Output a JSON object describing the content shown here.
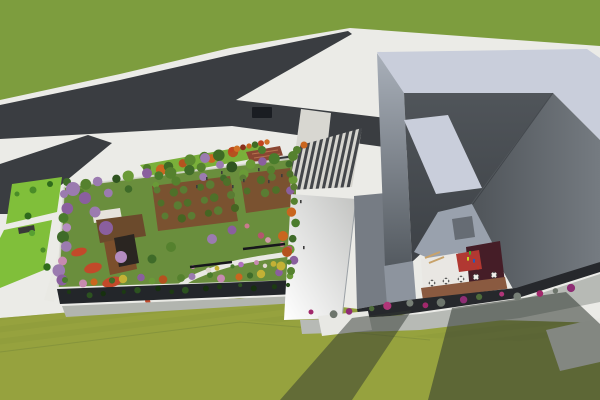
{
  "meta": {
    "title": "Aerial 3D architectural rendering",
    "description": "Bird's-eye render: angular gray museum building with courtyard cafe terrace, rooftop garden with orchards and winding paths, striped entry plaza, Y-shaped asphalt roads, lawns and flowering trees."
  },
  "colors": {
    "sidewalk": "#ebebe7",
    "sidewalk_shaded": "#b7bab5",
    "grass_north": "#7d9d3e",
    "lawn_south": "#96a23e",
    "lawn_bright": "#80bf3a",
    "road": "#3a3d41",
    "crosswalk": "#d8d7d1",
    "garden_lawn": "#6a8e3d",
    "soil": "#7a5230",
    "deck_wood": "#6b4a2c",
    "deck_dark": "#2a2521",
    "pergola_white": "#e6e3dc",
    "red_flowers": "#c2492a",
    "path": "#e9e9e4",
    "facade_dark": "#23262a",
    "facade_shadow": "#b2b5af",
    "amphitheater": "#8a4632",
    "pavilion": "#33363a",
    "parapet": "#c9cedb",
    "courtyard_wall": "#99a1ad",
    "floor_white": "#e9e7e3",
    "floor_red": "#b13832",
    "floor_maroon": "#451d27",
    "terrace": "#8a5a40",
    "panel_gray": "#666c74",
    "base_dark": "#26282c",
    "shadow": "#2f3630",
    "white_patch": "#e8e8e4"
  },
  "scene": {
    "tree_rows": [
      {
        "x1": 150,
        "y1": 170,
        "x2": 232,
        "y2": 152,
        "n": 9,
        "rmin": 4,
        "rmax": 6,
        "j": 1,
        "colors": [
          "#4f7d2b",
          "#c9661f",
          "#3f6b24",
          "#b5521f",
          "#5c8a30"
        ]
      },
      {
        "x1": 231,
        "y1": 150,
        "x2": 267,
        "y2": 142,
        "n": 7,
        "rmin": 2.5,
        "rmax": 3.5,
        "j": 0,
        "colors": [
          "#c0441f",
          "#d07026",
          "#8a2f1a",
          "#c9661f",
          "#3f6b24"
        ]
      },
      {
        "x1": 70,
        "y1": 184,
        "x2": 292,
        "y2": 158,
        "n": 16,
        "rmin": 4,
        "rmax": 6,
        "j": 1,
        "colors": [
          "#3f6b29",
          "#55812e",
          "#9b7bb0",
          "#2f5420",
          "#6a9a37",
          "#8a5f9e",
          "#4a7c2c",
          "#55812e"
        ]
      },
      {
        "x1": 84,
        "y1": 194,
        "x2": 270,
        "y2": 170,
        "n": 9,
        "rmin": 3,
        "rmax": 5,
        "j": 1,
        "colors": [
          "#55812e",
          "#9b7bb0",
          "#3f6b29",
          "#6a9a37"
        ]
      },
      {
        "x1": 67,
        "y1": 196,
        "x2": 61,
        "y2": 280,
        "n": 9,
        "rmin": 4,
        "rmax": 6.5,
        "j": 1,
        "colors": [
          "#9b7bb0",
          "#8a5f9e",
          "#4a7c2c",
          "#b48cc0",
          "#3f6b29",
          "#9b7bb0",
          "#c78ab0"
        ]
      },
      {
        "x1": 68,
        "y1": 282,
        "x2": 292,
        "y2": 274,
        "n": 17,
        "rmin": 3,
        "rmax": 4.5,
        "j": 1,
        "colors": [
          "#4a7c2c",
          "#c78ab0",
          "#c9661f",
          "#3f6b29",
          "#c3b135",
          "#8a5f9e",
          "#6a9a37",
          "#b5521f",
          "#55812e",
          "#9b7bb0"
        ]
      },
      {
        "x1": 292,
        "y1": 166,
        "x2": 293,
        "y2": 272,
        "n": 10,
        "rmin": 3.5,
        "rmax": 5,
        "j": 1,
        "colors": [
          "#3f6b29",
          "#6a9a37",
          "#8a5f9e",
          "#55812e",
          "#c9661f",
          "#4a7c2c"
        ]
      },
      {
        "x1": 160,
        "y1": 192,
        "x2": 224,
        "y2": 184,
        "n": 6,
        "rmin": 3.5,
        "rmax": 4.5,
        "j": 1,
        "colors": [
          "#5a7c33",
          "#4e7029"
        ]
      },
      {
        "x1": 164,
        "y1": 205,
        "x2": 228,
        "y2": 197,
        "n": 6,
        "rmin": 3.5,
        "rmax": 4.5,
        "j": 1,
        "colors": [
          "#4e7029",
          "#5a7c33"
        ]
      },
      {
        "x1": 168,
        "y1": 218,
        "x2": 232,
        "y2": 210,
        "n": 6,
        "rmin": 3.5,
        "rmax": 4.5,
        "j": 1,
        "colors": [
          "#5a7c33",
          "#466522"
        ]
      },
      {
        "x1": 246,
        "y1": 180,
        "x2": 288,
        "y2": 174,
        "n": 4,
        "rmin": 3.5,
        "rmax": 4.5,
        "j": 1,
        "colors": [
          "#5a7c33",
          "#4e7029"
        ]
      },
      {
        "x1": 250,
        "y1": 193,
        "x2": 292,
        "y2": 187,
        "n": 4,
        "rmin": 3.5,
        "rmax": 4.5,
        "j": 1,
        "colors": [
          "#4e7029",
          "#5a7c33"
        ]
      },
      {
        "x1": 196,
        "y1": 269,
        "x2": 288,
        "y2": 262,
        "n": 9,
        "rmin": 2,
        "rmax": 3,
        "j": 1,
        "colors": [
          "#c78ab0",
          "#e0d8d0",
          "#c3b135",
          "#4a7c2c",
          "#b06fc0"
        ]
      },
      {
        "x1": 250,
        "y1": 228,
        "x2": 290,
        "y2": 250,
        "n": 5,
        "rmin": 2.5,
        "rmax": 3.5,
        "j": 1,
        "colors": [
          "#c97a8e",
          "#b4556f",
          "#d09aa8"
        ]
      },
      {
        "x1": 72,
        "y1": 294,
        "x2": 288,
        "y2": 285,
        "n": 14,
        "rmin": 2,
        "rmax": 3.5,
        "j": 1,
        "colors": [
          "#1c3a12",
          "#2c5220",
          "#16300e"
        ]
      },
      {
        "x1": 314,
        "y1": 314,
        "x2": 574,
        "y2": 289,
        "n": 15,
        "rmin": 2.5,
        "rmax": 4.5,
        "j": 1,
        "colors": [
          "#a1286b",
          "#6d756c",
          "#8e2d74",
          "#4e6b3a",
          "#b03578",
          "#777f76"
        ]
      },
      {
        "x1": 20,
        "y1": 196,
        "x2": 48,
        "y2": 268,
        "n": 5,
        "rmin": 2.5,
        "rmax": 4,
        "j": 1,
        "colors": [
          "#4a8c28",
          "#2f6b1c",
          "#57a032"
        ]
      }
    ],
    "trees": [
      [
        73,
        189,
        7,
        "#9b7bb0"
      ],
      [
        85,
        198,
        6,
        "#8a5f9e"
      ],
      [
        106,
        228,
        7,
        "#8a5f9e"
      ],
      [
        95,
        212,
        5.5,
        "#9b7bb0"
      ],
      [
        121,
        257,
        6,
        "#b48cc0"
      ],
      [
        171,
        247,
        5,
        "#55812e"
      ],
      [
        152,
        259,
        4.5,
        "#3f6b29"
      ],
      [
        212,
        239,
        5,
        "#9b7bb0"
      ],
      [
        232,
        230,
        4.5,
        "#8a5f9e"
      ],
      [
        283,
        236,
        5,
        "#c9661f"
      ],
      [
        287,
        252,
        5,
        "#b5521f"
      ],
      [
        281,
        266,
        4.5,
        "#c3b135"
      ],
      [
        205,
        158,
        5,
        "#9b7bb0"
      ],
      [
        262,
        150,
        4,
        "#4a7c2c"
      ],
      [
        33,
        190,
        3.5,
        "#4a8c28"
      ],
      [
        50,
        184,
        3,
        "#2f6b1c"
      ],
      [
        297,
        150,
        4,
        "#55812e"
      ],
      [
        304,
        145,
        3.5,
        "#c9661f"
      ]
    ],
    "furniture": {
      "table_top": "#f2f1ed",
      "table_dot": "#2e2e30",
      "bench_log_color": "#c8a26a",
      "garden_bench_color": "#17171c",
      "tables": [
        [
          432,
          283
        ],
        [
          446,
          281
        ],
        [
          461,
          279
        ],
        [
          476,
          277
        ],
        [
          494,
          275
        ]
      ],
      "bench_logs": [
        [
          425,
          258,
          440,
          252
        ],
        [
          429,
          263,
          444,
          257
        ]
      ],
      "garden_benches": [
        [
          190,
          267,
          232,
          262
        ],
        [
          243,
          249,
          285,
          244
        ]
      ]
    },
    "people": {
      "plaza_color": "#3c3c3c",
      "plaza": [
        [
          206,
          177
        ],
        [
          221,
          171
        ],
        [
          243,
          179
        ],
        [
          258,
          168
        ],
        [
          232,
          185
        ],
        [
          281,
          174
        ],
        [
          196,
          185
        ],
        [
          268,
          180
        ],
        [
          300,
          200
        ],
        [
          303,
          246
        ]
      ],
      "courtyard": [
        [
          469,
          251,
          "#3fae2a"
        ],
        [
          473,
          259,
          "#2a57b8"
        ],
        [
          477,
          266,
          "#c23324"
        ],
        [
          467,
          257,
          "#c8d426"
        ]
      ]
    },
    "vehicle_bus": {
      "x": 252,
      "y": 107,
      "w": 20,
      "h": 11,
      "color": "#1a1d22"
    }
  }
}
